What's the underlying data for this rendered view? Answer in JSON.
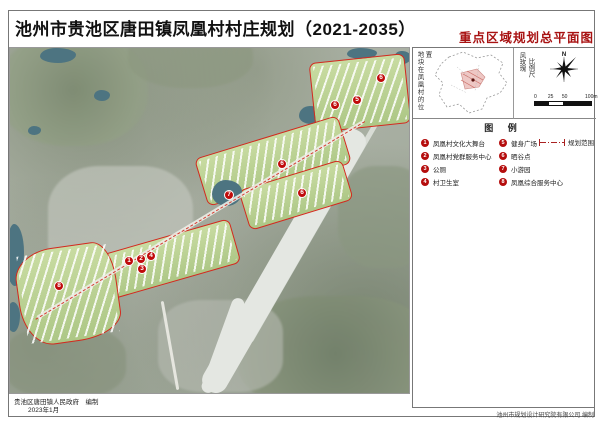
{
  "page": {
    "title": "池州市贵池区唐田镇凤凰村村庄规划（2021-2035）",
    "subtitle": "重点区域规划总平面图"
  },
  "colors": {
    "accent_red": "#a81212",
    "marker_red": "#c00b0b",
    "boundary_red": "#d42a1e",
    "water_teal": "#4d7481"
  },
  "locator": {
    "caption": "地块在凤凰村的位置"
  },
  "compass": {
    "caption_wind_rose": "风玫瑰",
    "caption_scale": "比例尺",
    "north_label": "N",
    "scale_ticks": [
      "0",
      "25",
      "50",
      "100m"
    ]
  },
  "legend": {
    "title": "图 例",
    "items": [
      {
        "num": "1",
        "label": "凤凰村文化大舞台"
      },
      {
        "num": "2",
        "label": "凤凰村党群服务中心"
      },
      {
        "num": "3",
        "label": "公厕"
      },
      {
        "num": "4",
        "label": "村卫生室"
      },
      {
        "num": "5",
        "label": "健身广场"
      },
      {
        "num": "6",
        "label": "晒谷点"
      },
      {
        "num": "7",
        "label": "小游园"
      },
      {
        "num": "8",
        "label": "凤凰综合服务中心"
      }
    ],
    "boundary_label": "规划范围"
  },
  "map": {
    "markers": [
      {
        "num": "6",
        "x": 325,
        "y": 57
      },
      {
        "num": "5",
        "x": 347,
        "y": 52
      },
      {
        "num": "6",
        "x": 371,
        "y": 30
      },
      {
        "num": "6",
        "x": 272,
        "y": 116
      },
      {
        "num": "7",
        "x": 219,
        "y": 147
      },
      {
        "num": "6",
        "x": 292,
        "y": 145
      },
      {
        "num": "1",
        "x": 119,
        "y": 213
      },
      {
        "num": "2",
        "x": 131,
        "y": 211
      },
      {
        "num": "4",
        "x": 141,
        "y": 208
      },
      {
        "num": "3",
        "x": 132,
        "y": 221
      },
      {
        "num": "8",
        "x": 49,
        "y": 238
      }
    ]
  },
  "footer": {
    "left_org": "贵池区唐田镇人民政府",
    "left_role": "编制",
    "left_date": "2023年1月",
    "right": "池州市规划设计研究院有限公司 编制"
  }
}
